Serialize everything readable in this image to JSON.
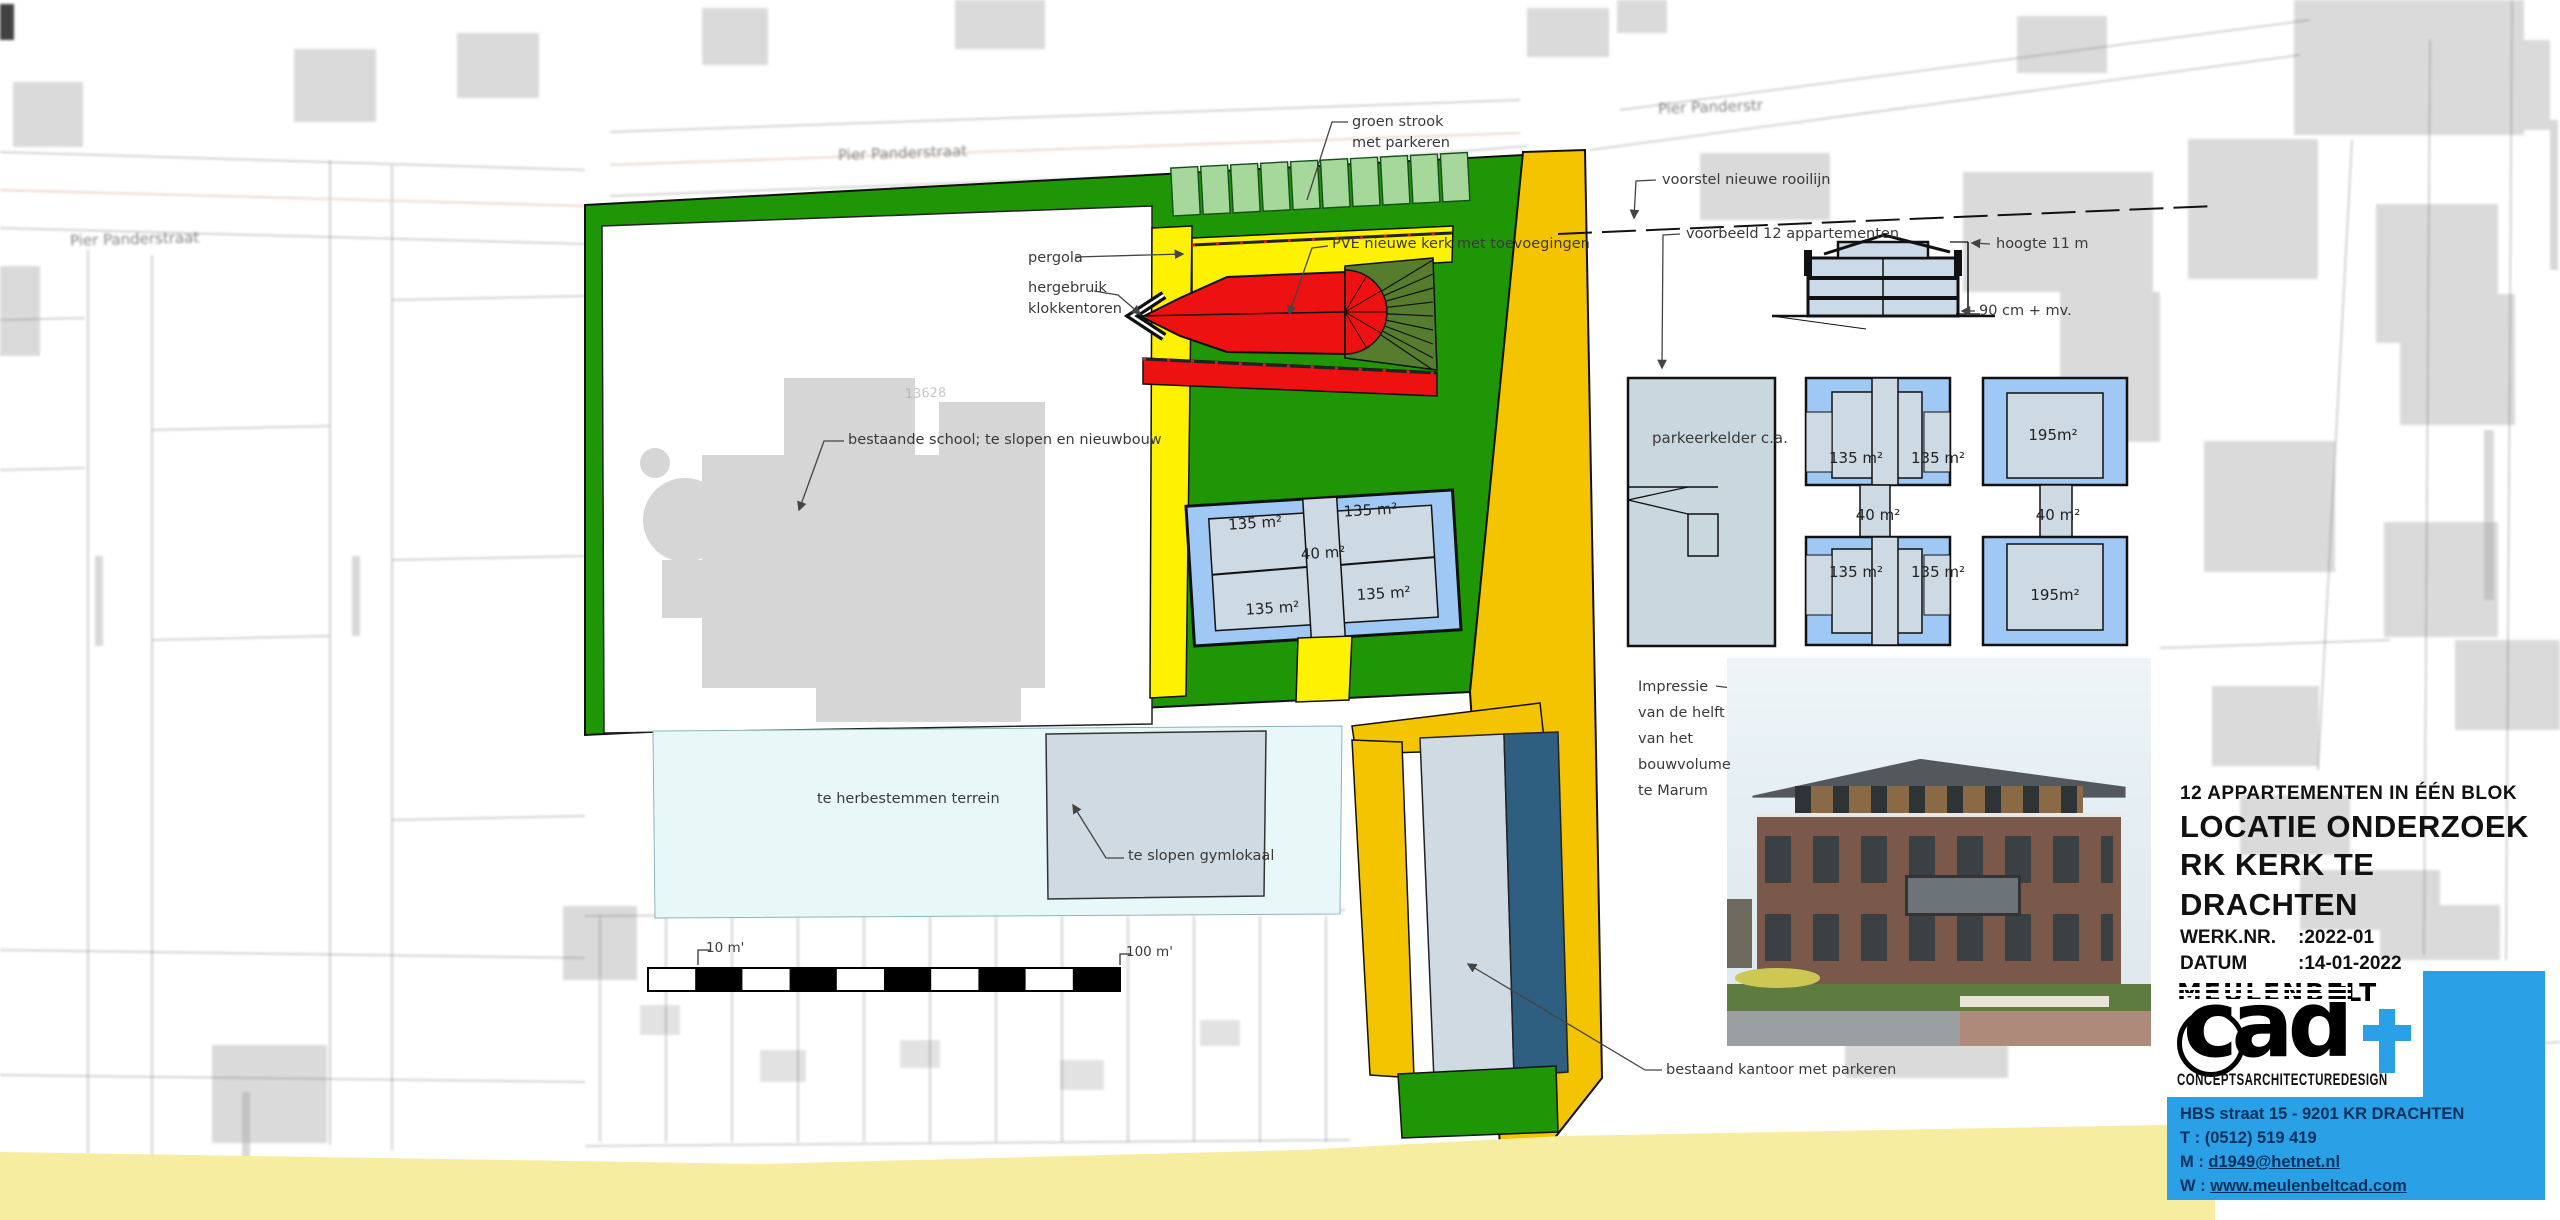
{
  "drawing": {
    "streets": {
      "left": "Pier Panderstraat",
      "mid": "Pier Panderstraat",
      "right": "Pier Panderstr"
    },
    "labels": {
      "groen_strook": [
        "groen strook",
        "met parkeren"
      ],
      "pergola": "pergola",
      "pve_kerk": "PVE nieuwe kerk met toevoegingen",
      "hergebruik": [
        "hergebruik",
        "klokkentoren"
      ],
      "rooilijn": "voorstel nieuwe rooilijn",
      "voorbeeld": "voorbeeld 12 appartementen",
      "hoogte": "hoogte 11 m",
      "peil": "90 cm + mv.",
      "school": "bestaande school; te slopen en nieuwbouw",
      "herbestemmen": "te herbestemmen terrein",
      "gymlokaal": "te slopen gymlokaal",
      "impressie": [
        "Impressie",
        "van de helft",
        "van het",
        "bouwvolume",
        "te Marum"
      ],
      "kantoor": "bestaand kantoor met parkeren",
      "parkeerkelder": "parkeerkelder c.a.",
      "parcel_number": "13628"
    },
    "unit_areas": {
      "m135": "135 m²",
      "m40": "40 m²",
      "m195": "195m²"
    },
    "scalebar": {
      "left": "10 m'",
      "right": "100 m'"
    }
  },
  "titleblock": {
    "subtitle": "12 APPARTEMENTEN IN ÉÉN BLOK",
    "title1": "LOCATIE ONDERZOEK",
    "title2": "RK KERK TE DRACHTEN",
    "rows": [
      {
        "label": "WERK.NR.",
        "value": ":2022-01"
      },
      {
        "label": "DATUM",
        "value": ":14-01-2022"
      },
      {
        "label": "BLADNR.",
        "value": ":02"
      }
    ]
  },
  "logo": {
    "name": "MEULENBELT",
    "cad": "cad",
    "tagline": [
      "CONCEPTS",
      "ARCHITECTURE",
      "DESIGN"
    ],
    "contact": {
      "address": "HBS straat 15 - 9201 KR DRACHTEN",
      "phone": "T : (0512) 519 419",
      "mail_prefix": "M :",
      "mail": "d1949@hetnet.nl",
      "web_prefix": "W :",
      "web": "www.meulenbeltcad.com"
    }
  },
  "colors": {
    "plan_green": "#1E9606",
    "parking_green": "#A6D89C",
    "path_yellow": "#FFF200",
    "road_orange": "#F5C400",
    "church_red": "#EE1111",
    "fan_olive": "#567D2E",
    "building_gray_blue": "#CFDAE2",
    "balcony_blue": "#A0C8F4",
    "parking_dark_blue": "#2E5E80",
    "reuse_cyan": "#E8F8F8",
    "road_pale_yellow": "#F6EDA0",
    "brand_blue": "#2AA0E6"
  }
}
